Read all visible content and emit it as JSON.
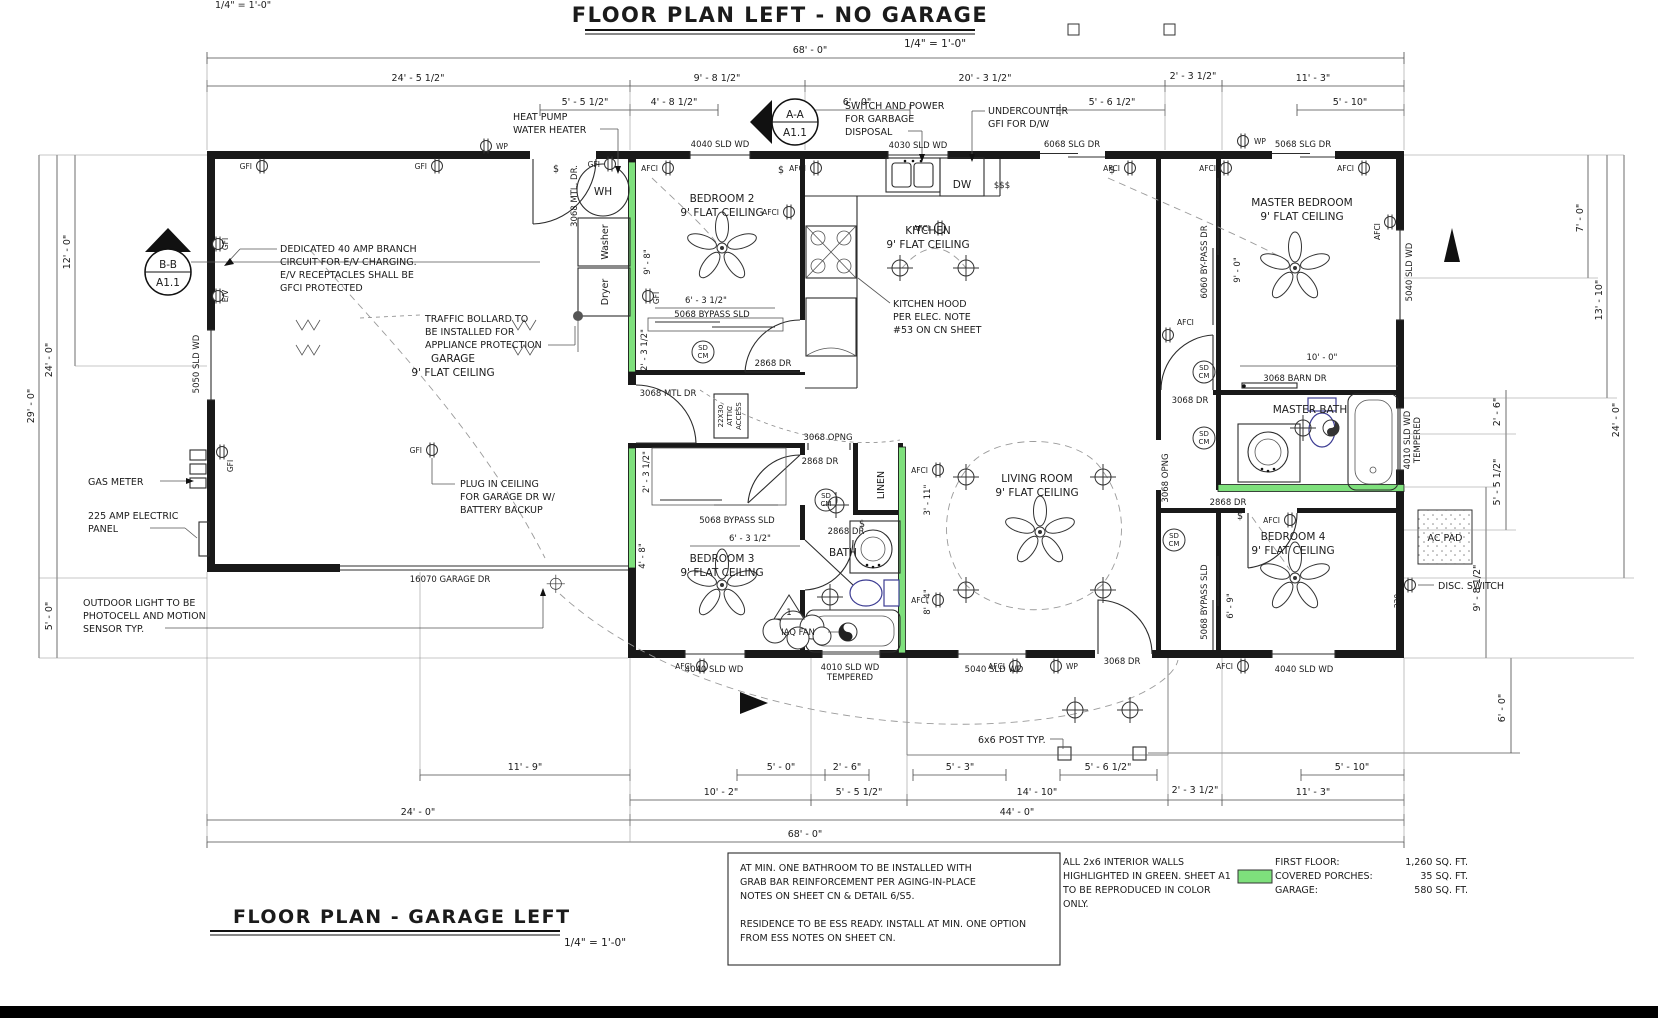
{
  "sheet": {
    "top_title": "FLOOR PLAN LEFT - NO GARAGE",
    "top_scale": "1/4\" = 1'-0\"",
    "corner_scale": "1/4\" = 1'-0\"",
    "bottom_title": "FLOOR PLAN - GARAGE LEFT",
    "bottom_scale": "1/4\" = 1'-0\""
  },
  "rooms": {
    "garage": [
      "GARAGE",
      "9' FLAT CEILING"
    ],
    "bedroom2": [
      "BEDROOM 2",
      "9' FLAT CEILING"
    ],
    "bedroom3": [
      "BEDROOM 3",
      "9' FLAT CEILING"
    ],
    "bedroom4": [
      "BEDROOM 4",
      "9' FLAT CEILING"
    ],
    "kitchen": [
      "KITCHEN",
      "9' FLAT CEILING"
    ],
    "living": [
      "LIVING ROOM",
      "9' FLAT CEILING"
    ],
    "master_bedroom": [
      "MASTER BEDROOM",
      "9' FLAT CEILING"
    ],
    "master_bath": "MASTER BATH",
    "bath": "BATH",
    "linen": "LINEN"
  },
  "fixtures": {
    "wh": "WH",
    "washer": "Washer",
    "dryer": "Dryer",
    "dw": "DW",
    "ac_pad": "AC PAD",
    "iaq_fan": "IAQ FAN",
    "attic1": "22X30",
    "attic2": "ATTIC",
    "attic3": "ACCESS",
    "one": "1"
  },
  "notes": {
    "heat_pump": [
      "HEAT PUMP",
      "WATER HEATER"
    ],
    "garbage": [
      "SWITCH AND POWER",
      "FOR GARBAGE",
      "DISPOSAL"
    ],
    "dw_gfi": [
      "UNDERCOUNTER",
      "GFI FOR D/W"
    ],
    "ev": [
      "DEDICATED 40 AMP BRANCH",
      "CIRCUIT FOR E/V CHARGING.",
      "E/V RECEPTACLES SHALL BE",
      "GFCI PROTECTED"
    ],
    "bollard": [
      "TRAFFIC BOLLARD TO",
      "BE INSTALLED FOR",
      "APPLIANCE PROTECTION"
    ],
    "hood": [
      "KITCHEN HOOD",
      "PER ELEC. NOTE",
      "#53 ON CN SHEET"
    ],
    "plug": [
      "PLUG IN CEILING",
      "FOR GARAGE DR W/",
      "BATTERY BACKUP"
    ],
    "gas": "GAS METER",
    "panel": [
      "225 AMP ELECTRIC",
      "PANEL"
    ],
    "outdoor": [
      "OUTDOOR LIGHT TO BE",
      "PHOTOCELL AND MOTION",
      "SENSOR TYP."
    ],
    "post": "6x6 POST TYP.",
    "disc": "DISC. SWITCH"
  },
  "labels": {
    "mtl_dr": "3068 MTL. DR.",
    "mtl_dr2": "3068 MTL DR",
    "sld4040": "4040 SLD WD",
    "sld4030": "4030 SLD WD",
    "slg6068": "6068 SLG DR",
    "slg5068": "5068 SLG DR",
    "byp5068": "5068 BYPASS SLD",
    "byp6060": "6060 BY-PASS DR",
    "barn3068": "3068 BARN DR",
    "dr3068": "3068 DR",
    "opng3068": "3068 OPNG",
    "dr2868": "2868 DR",
    "garage_dr": "16070 GARAGE DR",
    "sld5040": "5040 SLD WD",
    "sld4010": "4010 SLD WD",
    "tempered": "TEMPERED",
    "sld5050": "5050 SLD WD"
  },
  "symbols": {
    "afci": "AFCI",
    "gfi": "GFI",
    "wp": "WP",
    "sd": "SD",
    "cm": "CM",
    "sw": "$",
    "sw3": "$$$",
    "v220": "220",
    "ev": "E/V"
  },
  "markers": {
    "aa1": "A-A",
    "aa2": "A1.1",
    "bb1": "B-B",
    "bb2": "A1.1"
  },
  "dims": {
    "top": [
      "68' - 0\"",
      "24' - 5 1/2\"",
      "9' - 8 1/2\"",
      "20' - 3 1/2\"",
      "2' - 3 1/2\"",
      "11' - 3\"",
      "5' - 5 1/2\"",
      "4' - 8 1/2\"",
      "6' - 0\"",
      "5' - 6 1/2\"",
      "5' - 10\""
    ],
    "bottom": [
      "11' - 9\"",
      "5' - 0\"",
      "2' - 6\"",
      "5' - 3\"",
      "5' - 6 1/2\"",
      "5' - 10\"",
      "10' - 2\"",
      "5' - 5 1/2\"",
      "14' - 10\"",
      "2' - 3 1/2\"",
      "11' - 3\"",
      "24' - 0\"",
      "44' - 0\"",
      "68' - 0\""
    ],
    "left": [
      "12' - 0\"",
      "24' - 0\"",
      "29' - 0\"",
      "5' - 0\""
    ],
    "right": [
      "7' - 0\"",
      "13' - 10\"",
      "24' - 0\"",
      "2' - 6\"",
      "5' - 5 1/2\"",
      "9' - 8 1/2\"",
      "6' - 0\""
    ],
    "interior": [
      "9' - 8\"",
      "6' - 3 1/2\"",
      "2' - 3 1/2\"",
      "9' - 0\"",
      "10' - 0\"",
      "2' - 3 1/2\"",
      "4' - 8\"",
      "6' - 3 1/2\"",
      "3' - 11\"",
      "8' - 4\"",
      "6' - 9\""
    ]
  },
  "footer": {
    "box": [
      "AT MIN. ONE BATHROOM TO BE INSTALLED WITH",
      "GRAB BAR REINFORCEMENT PER AGING-IN-PLACE",
      "NOTES ON SHEET CN & DETAIL 6/S5.",
      "RESIDENCE TO BE ESS READY. INSTALL AT MIN. ONE OPTION",
      "FROM ESS NOTES ON SHEET CN."
    ],
    "green_note": [
      "ALL 2x6 INTERIOR WALLS",
      "HIGHLIGHTED IN GREEN. SHEET A1",
      "TO BE REPRODUCED IN COLOR",
      "ONLY."
    ],
    "areas": {
      "labels": [
        "FIRST FLOOR:",
        "COVERED PORCHES:",
        "GARAGE:"
      ],
      "values": [
        "1,260 SQ. FT.",
        "35 SQ. FT.",
        "580 SQ. FT."
      ]
    }
  },
  "colors": {
    "wall_green": "#7ee07c",
    "fixture_blue": "#3c3c92"
  }
}
